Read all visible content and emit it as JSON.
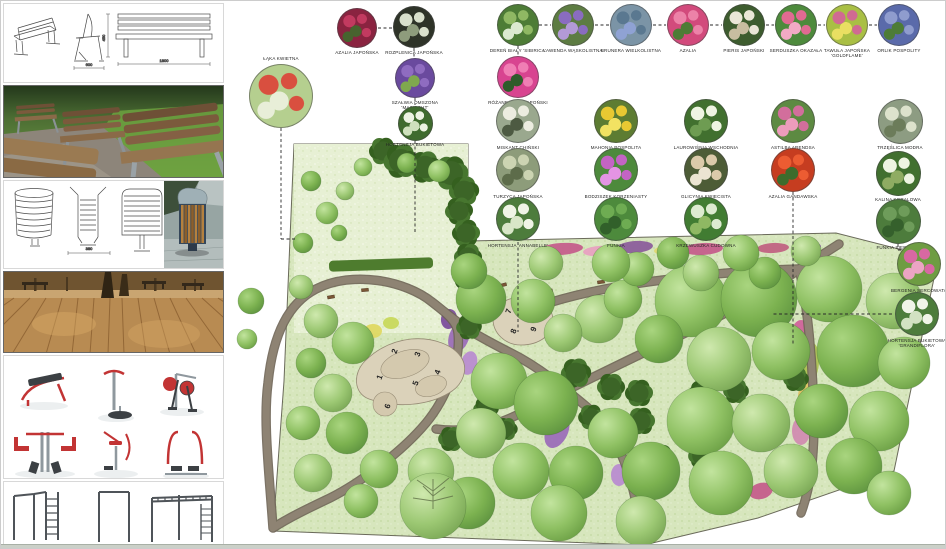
{
  "board": {
    "type": "landscape design presentation board"
  },
  "sidebar": {
    "sections": [
      {
        "id": "bench-technical-drawing",
        "content": "park bench technical drawings: perspective, side view, front view"
      },
      {
        "id": "bench-photo",
        "content": "photo of wooden park benches on gravel and grass"
      },
      {
        "id": "bin-technical-drawing",
        "content": "litter bin technical drawings and product photo"
      },
      {
        "id": "boardwalk-photo",
        "content": "photo of wooden boardwalk with trees and benches"
      },
      {
        "id": "fitness-equipment-renders",
        "content": "six outdoor gym machines, red and grey"
      },
      {
        "id": "calisthenics-renders",
        "content": "street workout pull-up and monkey bar structures"
      }
    ],
    "bench_drawing": {
      "dim_side": "600",
      "dim_front": "1800",
      "dim_height": "450"
    },
    "bin_drawing": {
      "dim_width": "380",
      "dim_height": "650"
    }
  },
  "legend": {
    "plants": [
      {
        "id": "laka-kwietna",
        "label": "ŁĄKA KWIETNA",
        "x": 280,
        "y": 95,
        "d": 64,
        "colors": [
          "#b5cf8f",
          "#d94f3f",
          "#e8eed8"
        ],
        "label_pos": "top"
      },
      {
        "id": "azalia-japonska",
        "label": "AZALIA JAPOŃSKA",
        "x": 356,
        "y": 27,
        "d": 40,
        "colors": [
          "#8a2340",
          "#c23a60",
          "#47632e"
        ]
      },
      {
        "id": "rozplenica-japonska",
        "label": "ROZPLENICA JAPOŃSKA",
        "x": 413,
        "y": 26,
        "d": 42,
        "colors": [
          "#2e3328",
          "#d9e0cc",
          "#8e9c7c"
        ]
      },
      {
        "id": "szalwia-omszona",
        "label": "SZAŁWIA OMSZONA 'MAINACHT'",
        "x": 414,
        "y": 77,
        "d": 40,
        "colors": [
          "#6a4a9e",
          "#8f6cc0",
          "#7fa84e"
        ]
      },
      {
        "id": "hortensja-bukietowa",
        "label": "HORTENSJA BUKIETOWA",
        "x": 414,
        "y": 122,
        "d": 35,
        "colors": [
          "#3f6b2e",
          "#edf3e3",
          "#cfe0bd"
        ]
      },
      {
        "id": "deren-bialy",
        "label": "DEREŃ BIAŁY 'SIBIRICA'",
        "x": 517,
        "y": 24,
        "d": 42,
        "colors": [
          "#4d7c36",
          "#8fb863",
          "#dcead0"
        ]
      },
      {
        "id": "lawenda-waskolistna",
        "label": "LAWENDA WĄSKOLISTNA",
        "x": 572,
        "y": 24,
        "d": 42,
        "colors": [
          "#5d7c42",
          "#8a6cc0",
          "#b39ad6"
        ]
      },
      {
        "id": "brunera-wielkolistna",
        "label": "BRUNERA WIELKOLISTNA",
        "x": 630,
        "y": 24,
        "d": 42,
        "colors": [
          "#7b94a6",
          "#5a7890",
          "#8fa2d4"
        ]
      },
      {
        "id": "azalia",
        "label": "AZALIA",
        "x": 687,
        "y": 24,
        "d": 42,
        "colors": [
          "#d24a7c",
          "#ec82a8",
          "#4d7c36"
        ]
      },
      {
        "id": "pieris-japonski",
        "label": "PIERIS JAPOŃSKI",
        "x": 743,
        "y": 24,
        "d": 42,
        "colors": [
          "#3d5c2e",
          "#eae6d6",
          "#c8bda0"
        ]
      },
      {
        "id": "serduszka-okazala",
        "label": "SERDUSZKA OKAZAŁA",
        "x": 795,
        "y": 24,
        "d": 42,
        "colors": [
          "#4d8a3c",
          "#e06a92",
          "#f2aac4"
        ]
      },
      {
        "id": "tawula-japonska",
        "label": "TAWUŁA JAPOŃSKA 'GOLDFLAME'",
        "x": 846,
        "y": 24,
        "d": 42,
        "colors": [
          "#a9bf44",
          "#d06a92",
          "#e9df62"
        ]
      },
      {
        "id": "orlik-pospolity",
        "label": "ORLIK POSPOLITY",
        "x": 898,
        "y": 24,
        "d": 42,
        "colors": [
          "#5a6aaa",
          "#8f9cce",
          "#4d7c36"
        ]
      },
      {
        "id": "rozanecznik",
        "label": "RÓŻANECZNIK JAPOŃSKI",
        "x": 517,
        "y": 76,
        "d": 42,
        "colors": [
          "#d84490",
          "#f07eb4",
          "#2f5c2a"
        ]
      },
      {
        "id": "miskant-chinski",
        "label": "MISKANT CHIŃSKI",
        "x": 517,
        "y": 120,
        "d": 44,
        "colors": [
          "#9aa88e",
          "#ecece0",
          "#4d5a42"
        ]
      },
      {
        "id": "turzyca-japonska",
        "label": "TURZYCA JAPOŃSKA",
        "x": 517,
        "y": 169,
        "d": 44,
        "colors": [
          "#8d9c7a",
          "#ccd4b2",
          "#5d6c4a"
        ]
      },
      {
        "id": "hortensja-annabelle",
        "label": "HORTENSJA 'ANNABELLE'",
        "x": 517,
        "y": 218,
        "d": 44,
        "colors": [
          "#4d7c3c",
          "#f0f4e6",
          "#d9e6c8"
        ]
      },
      {
        "id": "mahonia-pospolita",
        "label": "MAHONIA POSPOLITA",
        "x": 615,
        "y": 120,
        "d": 44,
        "colors": [
          "#5d7c32",
          "#e8c832",
          "#f2e262"
        ]
      },
      {
        "id": "bodziszek",
        "label": "BODZISZEK KORZENIASTY",
        "x": 615,
        "y": 169,
        "d": 44,
        "colors": [
          "#4d8a3c",
          "#c364c4",
          "#e494e4"
        ]
      },
      {
        "id": "funkia",
        "label": "FUNKIA",
        "x": 615,
        "y": 218,
        "d": 44,
        "colors": [
          "#4d8a3c",
          "#6eac52",
          "#31602a"
        ]
      },
      {
        "id": "laurowisnia",
        "label": "LAUROWIŚNIA WSCHODNIA",
        "x": 705,
        "y": 120,
        "d": 44,
        "colors": [
          "#41702f",
          "#eef4e2",
          "#6e9c52"
        ]
      },
      {
        "id": "glicynia",
        "label": "GLICYNIA KWIECISTA",
        "x": 705,
        "y": 169,
        "d": 44,
        "colors": [
          "#4d5c36",
          "#dccaaa",
          "#ece4d2"
        ]
      },
      {
        "id": "krzewuszka",
        "label": "KRZEWUSZKA CUDOWNA",
        "x": 705,
        "y": 218,
        "d": 44,
        "colors": [
          "#417c32",
          "#dcead0",
          "#8fb863"
        ]
      },
      {
        "id": "astilba",
        "label": "ASTILBA ARENDSA",
        "x": 792,
        "y": 120,
        "d": 44,
        "colors": [
          "#5d8a42",
          "#d26e9c",
          "#ec9cbc"
        ]
      },
      {
        "id": "azalia-gandawska",
        "label": "AZALIA GANDAWSKA",
        "x": 792,
        "y": 169,
        "d": 44,
        "colors": [
          "#c63d20",
          "#ec5c32",
          "#3d6c2c"
        ]
      },
      {
        "id": "trzeslica",
        "label": "TRZĘŚLICA MODRA",
        "x": 899,
        "y": 120,
        "d": 45,
        "colors": [
          "#8d9c82",
          "#dde2cc",
          "#6c7c5a"
        ]
      },
      {
        "id": "kalina",
        "label": "KALINA KORALOWA",
        "x": 897,
        "y": 172,
        "d": 45,
        "colors": [
          "#41702f",
          "#eef4e2",
          "#8fac62"
        ]
      },
      {
        "id": "funkia-siebolda",
        "label": "FUNKIA SIEBOLDA",
        "x": 897,
        "y": 220,
        "d": 45,
        "colors": [
          "#4d7c3c",
          "#6e9c5a",
          "#35602c"
        ]
      },
      {
        "id": "bergenia",
        "label": "BERGENIA SERCOWATA",
        "x": 918,
        "y": 263,
        "d": 44,
        "colors": [
          "#6e9c42",
          "#d868a2",
          "#eca4c4"
        ]
      },
      {
        "id": "hortensja-grandiflora",
        "label": "HORTENSJA BUKIETOWA 'GRANDIFLORA'",
        "x": 916,
        "y": 313,
        "d": 44,
        "colors": [
          "#4d7c3c",
          "#f0f4e8",
          "#d2e2c2"
        ]
      }
    ]
  },
  "plan": {
    "palette": {
      "lawn": "#d7e6bd",
      "meadow": "#e7f0d4",
      "path": "#8e8373",
      "plaza": "#dbd2ba",
      "tree_light": "#9ccb6e",
      "conifer": "#3c6527",
      "boundary": "#6a6a5a"
    },
    "markers": [
      {
        "n": "1",
        "x": 381,
        "y": 377
      },
      {
        "n": "2",
        "x": 396,
        "y": 351
      },
      {
        "n": "3",
        "x": 419,
        "y": 354
      },
      {
        "n": "4",
        "x": 439,
        "y": 372
      },
      {
        "n": "5",
        "x": 417,
        "y": 383
      },
      {
        "n": "6",
        "x": 389,
        "y": 406
      },
      {
        "n": "7",
        "x": 510,
        "y": 311
      },
      {
        "n": "8",
        "x": 515,
        "y": 331
      },
      {
        "n": "9",
        "x": 535,
        "y": 329
      }
    ],
    "trees": [
      [
        690,
        300,
        36,
        1
      ],
      [
        758,
        298,
        38,
        2
      ],
      [
        828,
        288,
        33,
        1
      ],
      [
        893,
        300,
        28,
        3
      ],
      [
        718,
        358,
        32,
        3
      ],
      [
        780,
        350,
        29,
        1
      ],
      [
        852,
        350,
        36,
        2
      ],
      [
        903,
        362,
        26,
        1
      ],
      [
        658,
        338,
        24,
        2
      ],
      [
        700,
        420,
        34,
        1
      ],
      [
        760,
        422,
        29,
        3
      ],
      [
        820,
        410,
        27,
        2
      ],
      [
        878,
        420,
        30,
        1
      ],
      [
        650,
        470,
        29,
        2
      ],
      [
        720,
        482,
        32,
        1
      ],
      [
        790,
        470,
        27,
        3
      ],
      [
        853,
        465,
        28,
        2
      ],
      [
        888,
        492,
        22,
        1
      ],
      [
        598,
        318,
        24,
        3
      ],
      [
        622,
        298,
        19,
        1
      ],
      [
        636,
        268,
        17,
        1
      ],
      [
        700,
        272,
        18,
        3
      ],
      [
        764,
        272,
        16,
        2
      ],
      [
        480,
        298,
        25,
        2
      ],
      [
        532,
        300,
        22,
        1
      ],
      [
        562,
        332,
        19,
        3
      ],
      [
        498,
        380,
        28,
        1
      ],
      [
        545,
        402,
        32,
        2
      ],
      [
        480,
        432,
        25,
        3
      ],
      [
        520,
        470,
        28,
        1
      ],
      [
        575,
        472,
        27,
        2
      ],
      [
        612,
        432,
        25,
        1
      ],
      [
        430,
        470,
        23,
        3
      ],
      [
        378,
        468,
        19,
        1
      ],
      [
        468,
        502,
        26,
        2
      ],
      [
        558,
        512,
        28,
        1
      ],
      [
        640,
        520,
        25,
        3
      ],
      [
        468,
        270,
        18,
        2
      ],
      [
        545,
        262,
        17,
        3
      ],
      [
        610,
        262,
        19,
        1
      ],
      [
        672,
        252,
        16,
        2
      ],
      [
        740,
        252,
        18,
        1
      ],
      [
        805,
        250,
        15,
        3
      ],
      [
        320,
        320,
        17,
        3
      ],
      [
        352,
        342,
        21,
        1
      ],
      [
        310,
        362,
        15,
        2
      ],
      [
        332,
        392,
        19,
        3
      ],
      [
        302,
        422,
        17,
        1
      ],
      [
        346,
        432,
        21,
        2
      ],
      [
        312,
        472,
        19,
        3
      ],
      [
        360,
        500,
        17,
        1
      ],
      [
        250,
        300,
        13,
        2
      ],
      [
        246,
        338,
        10,
        1
      ],
      [
        310,
        180,
        10,
        2
      ],
      [
        326,
        212,
        11,
        1
      ],
      [
        344,
        190,
        9,
        3
      ],
      [
        302,
        242,
        10,
        2
      ],
      [
        362,
        166,
        9,
        1
      ],
      [
        406,
        162,
        10,
        2
      ],
      [
        438,
        170,
        11,
        1
      ],
      [
        300,
        286,
        12,
        3
      ],
      [
        338,
        232,
        8,
        2
      ],
      [
        432,
        505,
        33,
        3
      ]
    ],
    "conifers": [
      [
        575,
        372,
        13
      ],
      [
        610,
        386,
        12
      ],
      [
        638,
        392,
        12
      ],
      [
        590,
        416,
        11
      ],
      [
        640,
        420,
        12
      ],
      [
        660,
        456,
        11
      ],
      [
        485,
        408,
        11
      ],
      [
        505,
        428,
        10
      ],
      [
        450,
        438,
        11
      ],
      [
        700,
        392,
        11
      ],
      [
        735,
        390,
        11
      ],
      [
        700,
        455,
        11
      ],
      [
        795,
        378,
        11
      ],
      [
        382,
        150,
        12
      ],
      [
        400,
        160,
        15
      ],
      [
        424,
        166,
        14
      ],
      [
        450,
        172,
        15
      ],
      [
        463,
        190,
        13
      ],
      [
        458,
        210,
        12
      ],
      [
        465,
        232,
        12
      ],
      [
        467,
        256,
        12
      ],
      [
        468,
        280,
        12
      ],
      [
        470,
        304,
        12
      ],
      [
        468,
        326,
        11
      ]
    ],
    "flowers": [
      [
        560,
        248,
        22,
        6,
        "#c45a8a",
        -4
      ],
      [
        598,
        250,
        16,
        5,
        "#e8a0c0",
        -4
      ],
      [
        634,
        246,
        18,
        6,
        "#8a5a9a",
        -4
      ],
      [
        668,
        249,
        15,
        5,
        "#e0d870",
        -4
      ],
      [
        702,
        248,
        20,
        6,
        "#c45a8a",
        -3
      ],
      [
        738,
        247,
        15,
        5,
        "#eae6da",
        -3
      ],
      [
        772,
        247,
        16,
        5,
        "#c06080",
        -3
      ],
      [
        806,
        246,
        14,
        5,
        "#9a6ab8",
        -3
      ],
      [
        458,
        336,
        10,
        16,
        "#9a6ab8",
        20
      ],
      [
        468,
        362,
        8,
        12,
        "#b88ad0",
        15
      ],
      [
        448,
        318,
        8,
        10,
        "#7a4a9a",
        10
      ],
      [
        556,
        430,
        11,
        18,
        "#9a6ab8",
        25
      ],
      [
        570,
        460,
        9,
        13,
        "#c45a8a",
        20
      ],
      [
        618,
        474,
        8,
        11,
        "#b88ad0",
        0
      ],
      [
        800,
        332,
        9,
        13,
        "#d0609a",
        0
      ],
      [
        810,
        362,
        8,
        20,
        "#aac050",
        5
      ],
      [
        806,
        396,
        9,
        16,
        "#e0c060",
        0
      ],
      [
        800,
        430,
        9,
        14,
        "#d08ab0",
        0
      ],
      [
        760,
        490,
        12,
        8,
        "#c45a8a",
        -15
      ],
      [
        732,
        504,
        10,
        6,
        "#e0e060",
        -15
      ],
      [
        372,
        330,
        9,
        7,
        "#e0d860",
        0
      ],
      [
        390,
        322,
        8,
        6,
        "#c8d858",
        0
      ]
    ],
    "benches": [
      [
        330,
        296,
        -10
      ],
      [
        364,
        289,
        -5
      ],
      [
        502,
        284,
        -15
      ],
      [
        548,
        290,
        -12
      ],
      [
        600,
        281,
        -8
      ],
      [
        680,
        275,
        -5
      ],
      [
        447,
        178,
        40
      ],
      [
        458,
        197,
        50
      ]
    ],
    "connectors": [
      [
        377,
        27,
        392,
        27
      ],
      [
        538,
        24,
        550,
        24
      ],
      [
        594,
        24,
        608,
        24
      ],
      [
        652,
        24,
        665,
        24
      ],
      [
        709,
        24,
        721,
        24
      ],
      [
        765,
        24,
        773,
        24
      ],
      [
        817,
        24,
        824,
        24
      ],
      [
        868,
        24,
        876,
        24
      ],
      [
        517,
        45,
        517,
        54
      ],
      [
        413,
        47,
        413,
        56
      ],
      [
        414,
        97,
        414,
        104
      ],
      [
        414,
        140,
        414,
        232
      ],
      [
        280,
        127,
        280,
        238
      ],
      [
        280,
        238,
        294,
        238
      ],
      [
        792,
        191,
        792,
        345
      ],
      [
        517,
        241,
        517,
        331
      ],
      [
        897,
        243,
        897,
        249
      ],
      [
        897,
        249,
        916,
        249
      ],
      [
        891,
        313,
        772,
        313
      ]
    ]
  }
}
